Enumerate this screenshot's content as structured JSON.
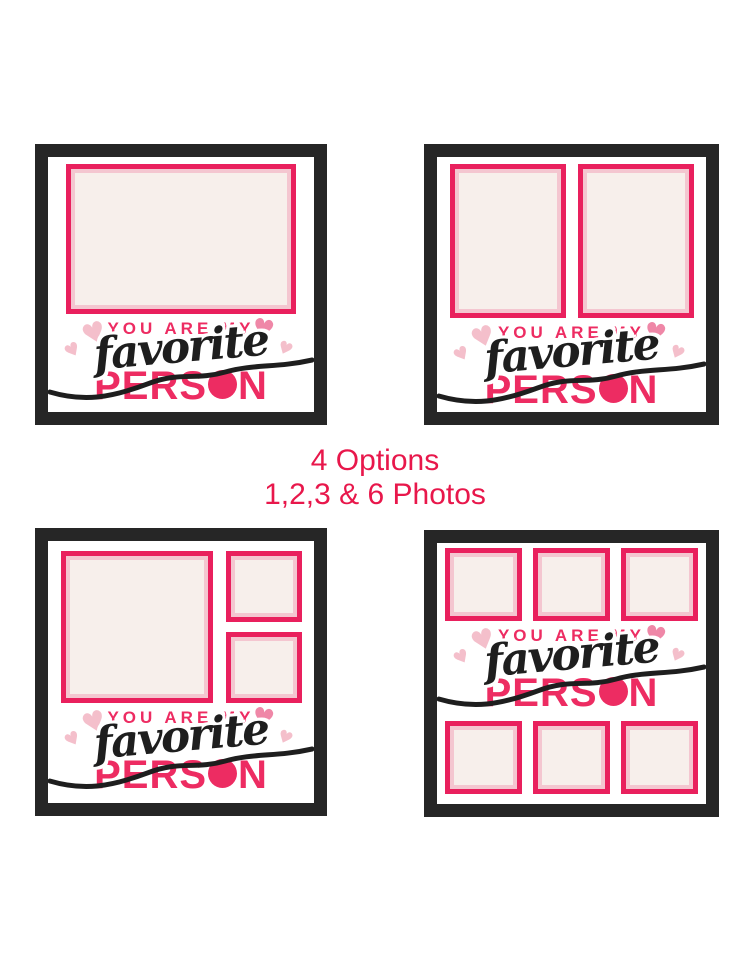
{
  "banner": {
    "line1": "4 Options",
    "line2": "1,2,3 & 6 Photos"
  },
  "caption": {
    "top_line": "YOU ARE MY",
    "script_word": "favorite",
    "bottom_word": "PERSON",
    "bottom_word_start": "PERS",
    "bottom_word_end": "N"
  },
  "icons": {
    "heart": "♥"
  },
  "frames": [
    {
      "name": "frame-1-photo",
      "photo_count": 1
    },
    {
      "name": "frame-2-photos",
      "photo_count": 2
    },
    {
      "name": "frame-3-photos",
      "photo_count": 3
    },
    {
      "name": "frame-6-photos",
      "photo_count": 6
    }
  ],
  "colors": {
    "accent_pink": "#ed2c62",
    "photo_border": "#e9205d",
    "photo_mat": "#f4c6d0",
    "photo_fill": "#f7efeb",
    "heart_light": "#f4bfcb",
    "heart_medium": "#ef87a7",
    "frame_black": "#262626",
    "banner_red": "#e8174b",
    "script_black": "#1e1e1e"
  }
}
